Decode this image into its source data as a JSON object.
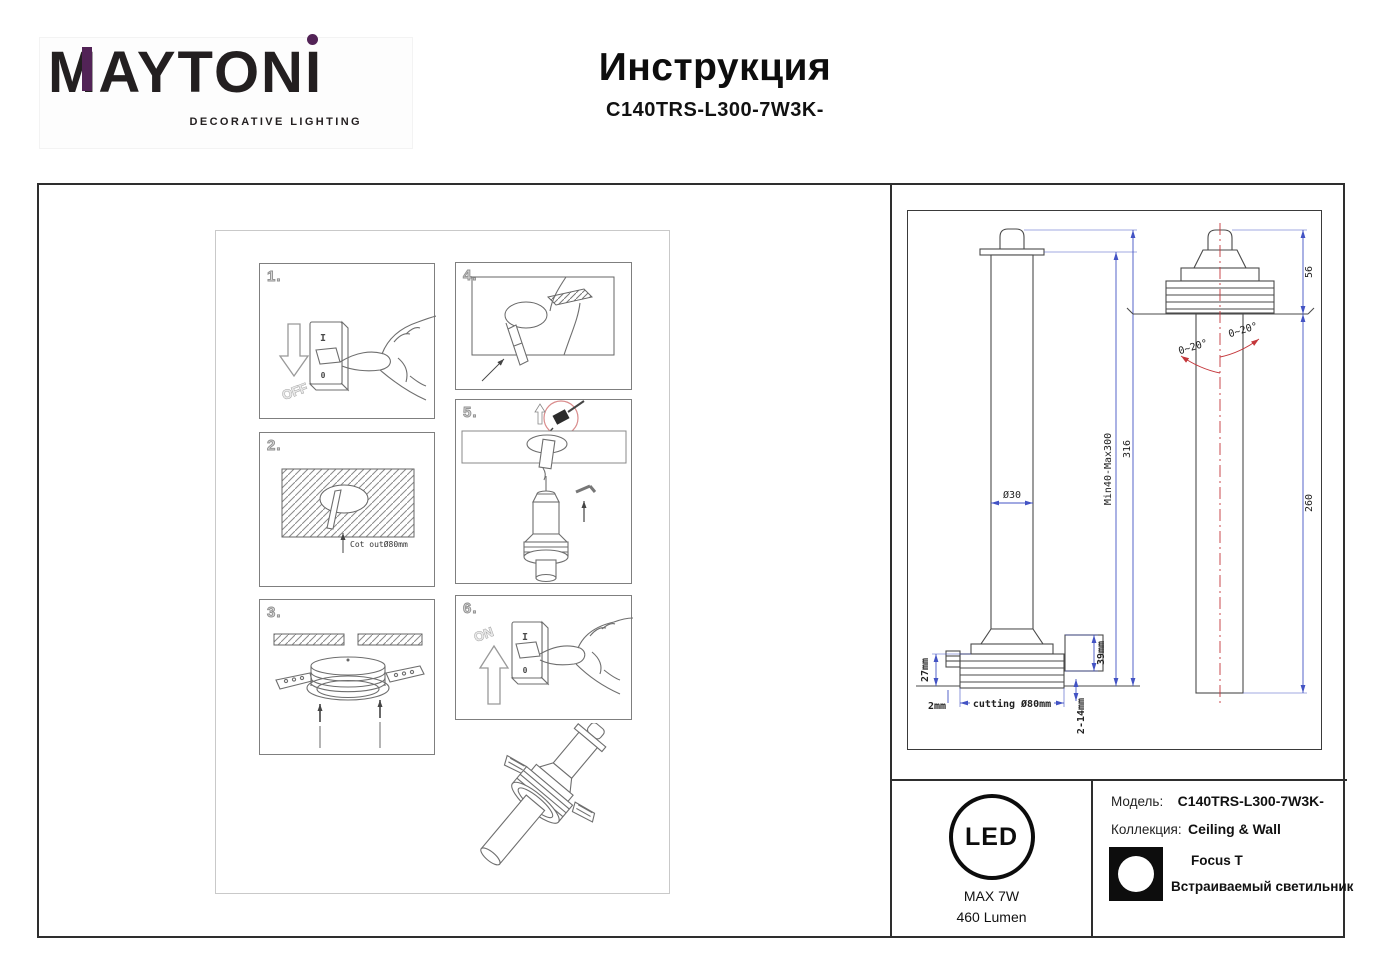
{
  "colors": {
    "accent_purple": "#522356",
    "dimension_blue": "#4353c4",
    "accent_red": "#c4373b",
    "line_gray": "#6e6e6e"
  },
  "header": {
    "logo_part1": "MAYTON",
    "logo_part2": "I",
    "logo_subtitle": "DECORATIVE LIGHTING",
    "title": "Инструкция",
    "model": "C140TRS-L300-7W3K-"
  },
  "instructions": {
    "step1": {
      "num": "1.",
      "arrow_label": "OFF",
      "switch_on_symbol": "I",
      "switch_off_symbol": "0"
    },
    "step2": {
      "num": "2.",
      "note": "Cot outØ80mm"
    },
    "step3": {
      "num": "3."
    },
    "step4": {
      "num": "4."
    },
    "step5": {
      "num": "5."
    },
    "step6": {
      "num": "6.",
      "arrow_label": "ON",
      "switch_on_symbol": "I",
      "switch_off_symbol": "0"
    }
  },
  "tech": {
    "dims": {
      "diameter": "Ø30",
      "range": "Min40-Max300",
      "total": "316",
      "flange": "27mm",
      "gap": "2mm",
      "cutting": "cutting Ø80mm",
      "clip": "39mm",
      "ceiling": "2-14mm",
      "head": "56",
      "body": "260",
      "angle_left": "0~20°",
      "angle_right": "0~20°"
    }
  },
  "footer": {
    "led_text": "LED",
    "max_power": "MAX 7W",
    "lumen": "460 Lumen",
    "model_label": "Модель:",
    "model_value": "C140TRS-L300-7W3K-",
    "collection_label": "Коллекция:",
    "collection_value": "Ceiling & Wall",
    "series": "Focus T",
    "type": "Встраиваемый светильник"
  }
}
